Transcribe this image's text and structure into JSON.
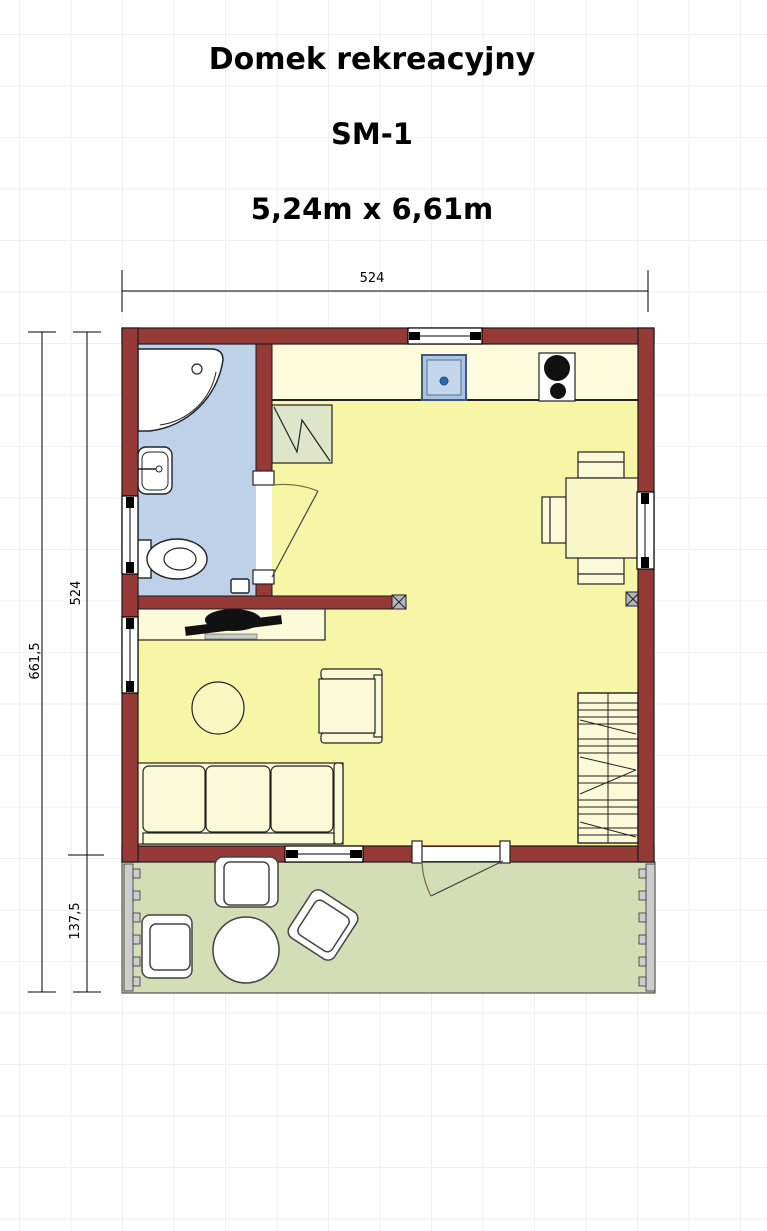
{
  "header": {
    "title": "Domek rekreacyjny",
    "model": "SM-1",
    "dimensions_label": "5,24m x 6,61m"
  },
  "dimension_annotations": {
    "top_width_cm": "524",
    "left_total_height_cm": "661,5",
    "left_house_height_cm": "524",
    "left_terrace_height_cm": "137,5"
  },
  "palette": {
    "wall": "#963a38",
    "floor": "#f7f5a6",
    "bathroom_floor": "#bdd1e9",
    "terrace_floor": "#d3ddb6",
    "kitchen_counter": "#fcfcdc",
    "furniture_fill": "#fbfad8",
    "wardrobe_fill": "#dde6c9",
    "sink_fill": "#aac4e1",
    "burner_color": "#111111",
    "outline": "#1c1c1c"
  },
  "rooms": [
    {
      "name": "bathroom"
    },
    {
      "name": "main-room-with-kitchenette"
    },
    {
      "name": "terrace"
    }
  ],
  "fixture_symbols": [
    "corner-shower",
    "washbasin",
    "toilet",
    "kitchen-sink",
    "cooktop",
    "wardrobe",
    "kitchen-counter",
    "dining-table-with-chairs",
    "staircase",
    "sideboard-with-tv",
    "coffee-table",
    "armchair",
    "three-seat-sofa",
    "terrace-round-table",
    "terrace-armchairs",
    "terrace-railing",
    "windows",
    "doors",
    "wall-vent-boxes"
  ]
}
